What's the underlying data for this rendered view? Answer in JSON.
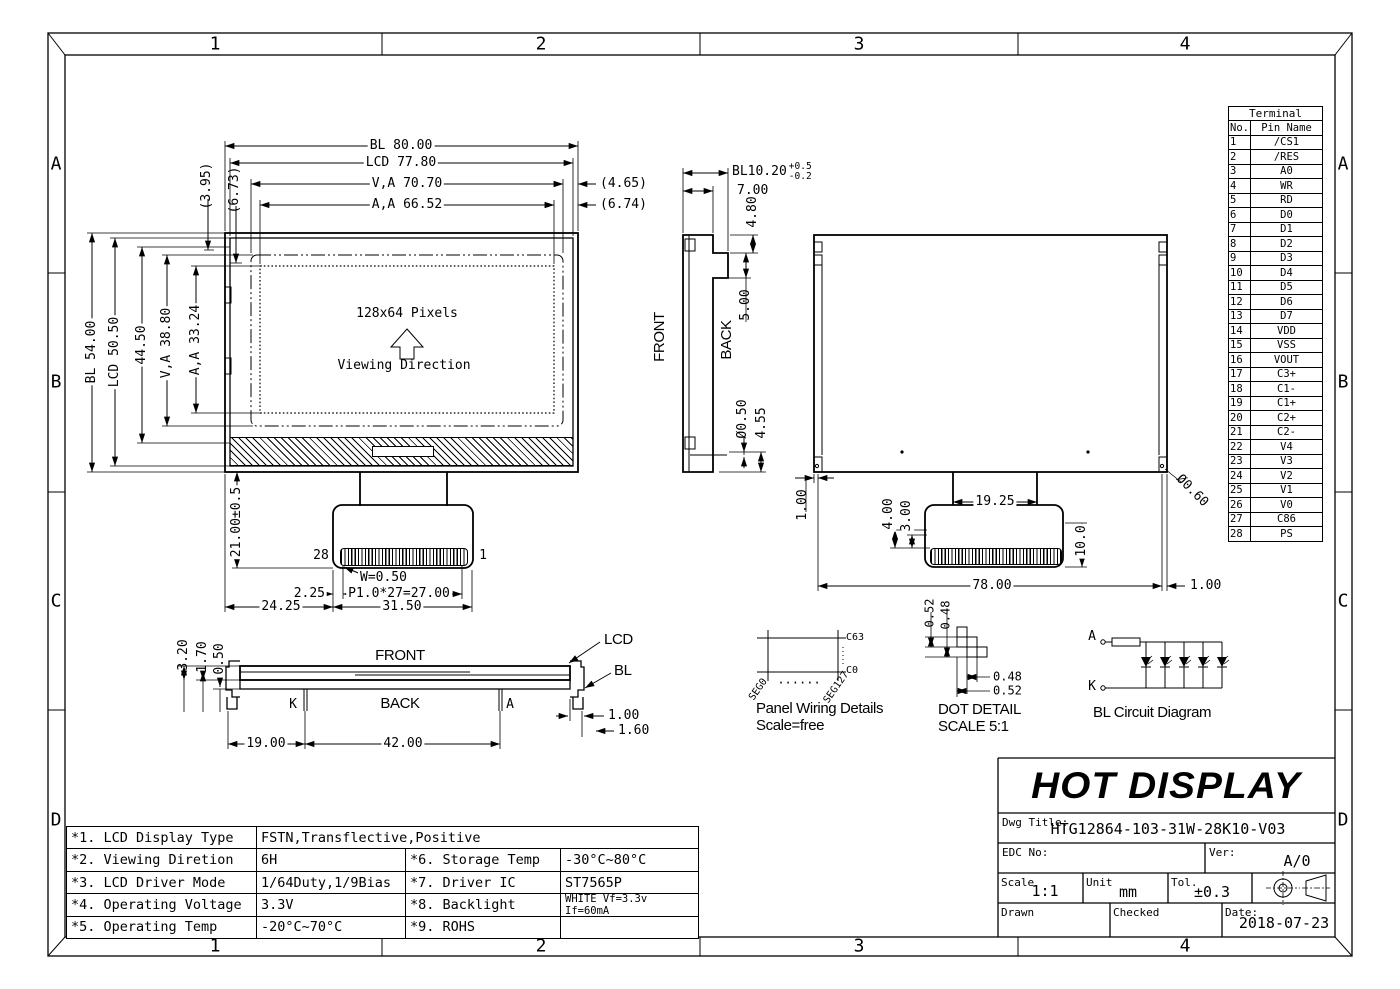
{
  "colors": {
    "ink": "#000000",
    "paper": "#ffffff"
  },
  "grid": {
    "cols": [
      "1",
      "2",
      "3",
      "4"
    ],
    "rows": [
      "A",
      "B",
      "C",
      "D"
    ]
  },
  "front_view": {
    "dim_bl_w": "BL 80.00",
    "dim_lcd_w": "LCD 77.80",
    "dim_va_w": "V,A 70.70",
    "dim_aa_w": "A,A 66.52",
    "dim_r465": "(4.65)",
    "dim_r674": "(6.74)",
    "dim_t395": "(3.95)",
    "dim_t673": "(6.73)",
    "dim_bl_h": "BL 54.00",
    "dim_lcd_h": "LCD 50.50",
    "dim_4450": "44.50",
    "dim_va_h": "V,A 38.80",
    "dim_aa_h": "A,A 33.24",
    "pixels_label": "128x64 Pixels",
    "viewing_label": "Viewing Direction",
    "pin_28": "28",
    "pin_1": "1",
    "dim_tail": "21.00±0.5",
    "dim_w": "W=0.50",
    "dim_pitch": "P1.0*27=27.00",
    "dim_225": "2.25",
    "dim_2425": "24.25",
    "dim_3150": "31.50"
  },
  "side_view": {
    "front_label": "FRONT",
    "back_label": "BACK",
    "dim_bl": "BL10.20",
    "tol_plus": "+0.5",
    "tol_minus": "-0.2",
    "dim_700": "7.00",
    "dim_480": "4.80",
    "dim_500": "5.00",
    "dim_dia": "Ø0.50",
    "dim_455": "4.55"
  },
  "back_view": {
    "dim_1925": "19.25",
    "dim_400": "4.00",
    "dim_300": "3.00",
    "dim_100_left": "1.00",
    "dim_100": "10.0",
    "dim_7800": "78.00",
    "dim_100_right": "1.00",
    "dim_dia": "Ø0.60"
  },
  "section_view": {
    "front_label": "FRONT",
    "back_label": "BACK",
    "lcd_label": "LCD",
    "bl_label": "BL",
    "k_label": "K",
    "a_label": "A",
    "dim_320": "3.20",
    "dim_170": "1.70",
    "dim_050": "0.50",
    "dim_1900": "19.00",
    "dim_4200": "42.00",
    "dim_100": "1.00",
    "dim_160": "1.60"
  },
  "panel_wiring": {
    "c63": "C63",
    "c0": "C0",
    "seg0": "SEG0",
    "seg127": "SEG127",
    "dots": "......",
    "title": "Panel Wiring Details",
    "scale": "Scale=free"
  },
  "dot_detail": {
    "dim_v052": "0.52",
    "dim_v048": "0.48",
    "dim_h048": "0.48",
    "dim_h052": "0.52",
    "title": "DOT DETAIL",
    "scale": "SCALE 5:1"
  },
  "bl_circuit": {
    "anode": "A",
    "cathode": "K",
    "title": "BL Circuit Diagram",
    "led_count": 5
  },
  "terminal": {
    "title": "Terminal",
    "col_no": "No.",
    "col_name": "Pin Name",
    "rows": [
      [
        "1",
        "/CS1"
      ],
      [
        "2",
        "/RES"
      ],
      [
        "3",
        "A0"
      ],
      [
        "4",
        "WR"
      ],
      [
        "5",
        "RD"
      ],
      [
        "6",
        "D0"
      ],
      [
        "7",
        "D1"
      ],
      [
        "8",
        "D2"
      ],
      [
        "9",
        "D3"
      ],
      [
        "10",
        "D4"
      ],
      [
        "11",
        "D5"
      ],
      [
        "12",
        "D6"
      ],
      [
        "13",
        "D7"
      ],
      [
        "14",
        "VDD"
      ],
      [
        "15",
        "VSS"
      ],
      [
        "16",
        "VOUT"
      ],
      [
        "17",
        "C3+"
      ],
      [
        "18",
        "C1-"
      ],
      [
        "19",
        "C1+"
      ],
      [
        "20",
        "C2+"
      ],
      [
        "21",
        "C2-"
      ],
      [
        "22",
        "V4"
      ],
      [
        "23",
        "V3"
      ],
      [
        "24",
        "V2"
      ],
      [
        "25",
        "V1"
      ],
      [
        "26",
        "V0"
      ],
      [
        "27",
        "C86"
      ],
      [
        "28",
        "PS"
      ]
    ]
  },
  "title_block": {
    "company": "HOT DISPLAY",
    "dwg_title_label": "Dwg Title:",
    "dwg_title": "HTG12864-103-31W-28K10-V03",
    "edc_label": "EDC No:",
    "ver_label": "Ver:",
    "ver": "A/0",
    "scale_label": "Scale",
    "scale": "1:1",
    "unit_label": "Unit",
    "unit": "mm",
    "tol_label": "Tol.",
    "tol": "±0.3",
    "drawn_label": "Drawn",
    "checked_label": "Checked",
    "date_label": "Date:",
    "date": "2018-07-23"
  },
  "spec_table": {
    "r1_label": "*1. LCD Display Type",
    "r1_value": "FSTN,Transflective,Positive",
    "r2_label": "*2. Viewing Diretion",
    "r2_value": "6H",
    "r6_label": "*6. Storage Temp",
    "r6_value": "-30°C~80°C",
    "r3_label": "*3. LCD Driver Mode",
    "r3_value": "1/64Duty,1/9Bias",
    "r7_label": "*7. Driver IC",
    "r7_value": "ST7565P",
    "r4_label": "*4. Operating Voltage",
    "r4_value": "3.3V",
    "r8_label": "*8. Backlight",
    "r8_value": "WHITE Vf=3.3v If=60mA",
    "r5_label": "*5. Operating Temp",
    "r5_value": "-20°C~70°C",
    "r9_label": "*9. ROHS",
    "r9_value": ""
  },
  "icons": {
    "viewing_arrow": "up-arrow-outline",
    "projection_symbol": "third-angle-projection",
    "led_symbol": "diode-down-triangle"
  }
}
